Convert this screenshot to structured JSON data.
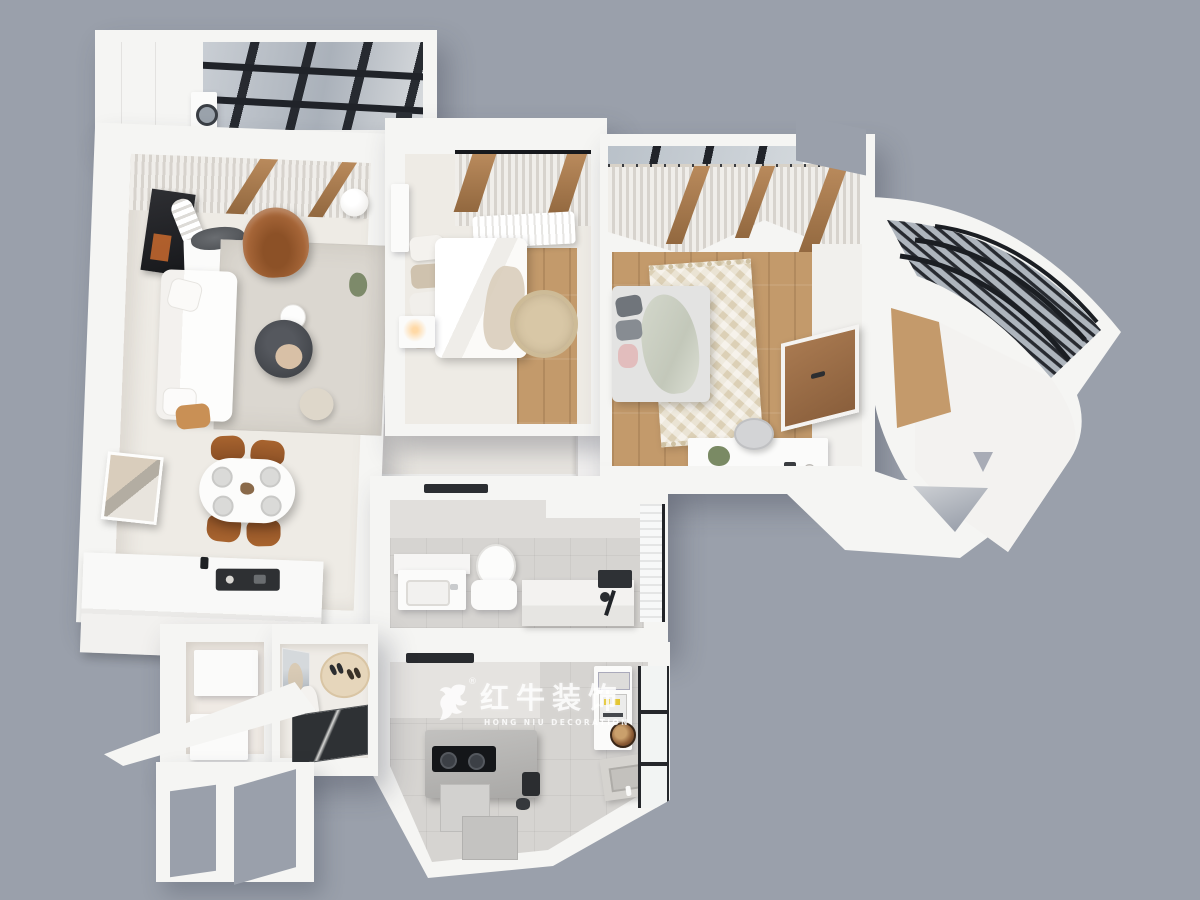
{
  "watermark": {
    "brand_cn": "红牛装饰",
    "brand_en": "HONG NIU DECORATION",
    "registered_mark": "®",
    "logo_icon": "bull-logo-icon"
  },
  "palette": {
    "bg": "#9aa0ab",
    "wall": "#f5f5f3",
    "wallshade": "#e8e7e4",
    "floor": "#eeebe5",
    "tile": "#d6d4d1",
    "wood": "#c39a6b",
    "rug": "#dbd7d0",
    "dark": "#26282c",
    "leather": "#a9683a",
    "woodtrim": "#a87c50",
    "glass": "#b3bac2",
    "mattan": "#e6d6bb",
    "warm": "#ffd9a6"
  }
}
